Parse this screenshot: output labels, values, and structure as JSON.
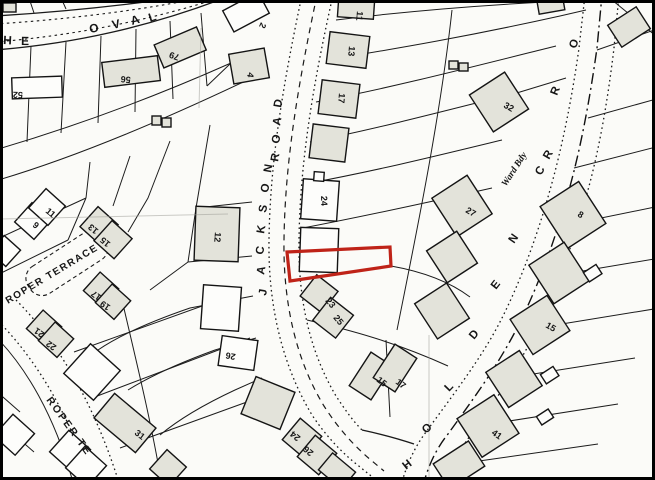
{
  "map": {
    "type": "cadastral-site-plan",
    "highlight_color": "#bf2318",
    "paper_color": "#fbfbf8",
    "streets_visible": [
      "HE OVAL",
      "JACKSON ROAD",
      "ROPER TERRACE",
      "ROPER TE",
      "HOLDEN",
      "CR",
      "RO"
    ],
    "annotation": "Ward Bdy",
    "plot_numbers_visible": [
      "52",
      "56",
      "79",
      "2",
      "4",
      "12",
      "11",
      "13",
      "17",
      "24",
      "23",
      "25",
      "26",
      "9",
      "11",
      "13",
      "15",
      "17",
      "19",
      "21",
      "22",
      "31",
      "24",
      "26",
      "15",
      "17",
      "41",
      "27",
      "32",
      "8",
      "15"
    ]
  },
  "labels": [
    {
      "name": "street-letter-oval-h",
      "text": "H",
      "x": 3,
      "y": 44,
      "rot": 3,
      "fs": 12,
      "cls": "street"
    },
    {
      "name": "street-letter-oval-e",
      "text": "E",
      "x": 21,
      "y": 45,
      "rot": 1,
      "fs": 12,
      "cls": "street"
    },
    {
      "name": "street-letter-oval-o",
      "text": "O",
      "x": 90,
      "y": 33,
      "rot": -10,
      "fs": 12,
      "cls": "street"
    },
    {
      "name": "street-letter-oval-v",
      "text": "V",
      "x": 113,
      "y": 29,
      "rot": -13,
      "fs": 12,
      "cls": "street"
    },
    {
      "name": "street-letter-oval-a",
      "text": "A",
      "x": 132,
      "y": 25,
      "rot": -16,
      "fs": 12,
      "cls": "street"
    },
    {
      "name": "street-letter-oval-l",
      "text": "L",
      "x": 150,
      "y": 22,
      "rot": -18,
      "fs": 12,
      "cls": "street"
    },
    {
      "name": "street-letter-jackson-j",
      "text": "J",
      "x": 266,
      "y": 296,
      "rot": -80,
      "fs": 11.5,
      "cls": "street"
    },
    {
      "name": "street-letter-jackson-a",
      "text": "A",
      "x": 264,
      "y": 275,
      "rot": -80,
      "fs": 11.5,
      "cls": "street"
    },
    {
      "name": "street-letter-jackson-c",
      "text": "C",
      "x": 263,
      "y": 255,
      "rot": -80,
      "fs": 11.5,
      "cls": "street"
    },
    {
      "name": "street-letter-jackson-k",
      "text": "K",
      "x": 264,
      "y": 234,
      "rot": -80,
      "fs": 11.5,
      "cls": "street"
    },
    {
      "name": "street-letter-jackson-s",
      "text": "S",
      "x": 266,
      "y": 213,
      "rot": -80,
      "fs": 11.5,
      "cls": "street"
    },
    {
      "name": "street-letter-jackson-o",
      "text": "O",
      "x": 268,
      "y": 193,
      "rot": -80,
      "fs": 11.5,
      "cls": "street"
    },
    {
      "name": "street-letter-jackson-n",
      "text": "N",
      "x": 271,
      "y": 173,
      "rot": -80,
      "fs": 11.5,
      "cls": "street"
    },
    {
      "name": "street-letter-road-r",
      "text": "R",
      "x": 278,
      "y": 162,
      "rot": -80,
      "fs": 11.5,
      "cls": "street"
    },
    {
      "name": "street-letter-road-o",
      "text": "O",
      "x": 279,
      "y": 144,
      "rot": -80,
      "fs": 11.5,
      "cls": "street"
    },
    {
      "name": "street-letter-road-a",
      "text": "A",
      "x": 280,
      "y": 126,
      "rot": -80,
      "fs": 11.5,
      "cls": "street"
    },
    {
      "name": "street-letter-road-d",
      "text": "D",
      "x": 281,
      "y": 108,
      "rot": -80,
      "fs": 11.5,
      "cls": "street"
    },
    {
      "name": "street-letter-holden-h",
      "text": "H",
      "x": 406,
      "y": 470,
      "rot": -38,
      "fs": 11.5,
      "cls": "street"
    },
    {
      "name": "street-letter-holden-o",
      "text": "O",
      "x": 426,
      "y": 434,
      "rot": -42,
      "fs": 11.5,
      "cls": "street"
    },
    {
      "name": "street-letter-holden-l",
      "text": "L",
      "x": 449,
      "y": 392,
      "rot": -46,
      "fs": 11.5,
      "cls": "street"
    },
    {
      "name": "street-letter-holden-d",
      "text": "D",
      "x": 474,
      "y": 340,
      "rot": -50,
      "fs": 11.5,
      "cls": "street"
    },
    {
      "name": "street-letter-holden-e",
      "text": "E",
      "x": 496,
      "y": 290,
      "rot": -52,
      "fs": 11.5,
      "cls": "street"
    },
    {
      "name": "street-letter-holden-n",
      "text": "N",
      "x": 514,
      "y": 244,
      "rot": -55,
      "fs": 11.5,
      "cls": "street"
    },
    {
      "name": "street-letter-cr-c",
      "text": "C",
      "x": 541,
      "y": 176,
      "rot": -60,
      "fs": 11.5,
      "cls": "street"
    },
    {
      "name": "street-letter-cr-r",
      "text": "R",
      "x": 549,
      "y": 160,
      "rot": -60,
      "fs": 11.5,
      "cls": "street"
    },
    {
      "name": "street-letter-ro-r",
      "text": "R",
      "x": 557,
      "y": 96,
      "rot": -68,
      "fs": 11.5,
      "cls": "street"
    },
    {
      "name": "street-letter-ro-o",
      "text": "O",
      "x": 576,
      "y": 49,
      "rot": -72,
      "fs": 11.5,
      "cls": "street"
    },
    {
      "name": "ward-bdy-label",
      "text": "Ward Bdy",
      "x": 506,
      "y": 187,
      "rot": -57,
      "fs": 9.5,
      "cls": "ward"
    },
    {
      "name": "street-label-roper-terrace",
      "text": "ROPER TERRACE",
      "x": 8,
      "y": 304,
      "rot": -31,
      "fs": 10,
      "ls": 1.5,
      "cls": "streetw"
    },
    {
      "name": "street-label-roper-te",
      "text": "ROPER TE",
      "x": 46,
      "y": 400,
      "rot": 54,
      "fs": 10.5,
      "ls": 2,
      "cls": "streetw"
    },
    {
      "name": "plot-number",
      "text": "52",
      "x": 23,
      "y": 92,
      "rot": 182,
      "fs": 9,
      "cls": "num"
    },
    {
      "name": "plot-number",
      "text": "56",
      "x": 131,
      "y": 77,
      "rot": 186,
      "fs": 9,
      "cls": "num"
    },
    {
      "name": "plot-number",
      "text": "79",
      "x": 180,
      "y": 55,
      "rot": 200,
      "fs": 9,
      "cls": "num"
    },
    {
      "name": "plot-number",
      "text": "2",
      "x": 261,
      "y": 22,
      "rot": 115,
      "fs": 9,
      "cls": "num"
    },
    {
      "name": "plot-number",
      "text": "4",
      "x": 248,
      "y": 72,
      "rot": 100,
      "fs": 9,
      "cls": "num"
    },
    {
      "name": "plot-number",
      "text": "12",
      "x": 215,
      "y": 232,
      "rot": 95,
      "fs": 9,
      "cls": "num"
    },
    {
      "name": "plot-number",
      "text": "11",
      "x": 357,
      "y": 11,
      "rot": 95,
      "fs": 9,
      "cls": "num"
    },
    {
      "name": "plot-number",
      "text": "13",
      "x": 349,
      "y": 46,
      "rot": 95,
      "fs": 9,
      "cls": "num"
    },
    {
      "name": "plot-number",
      "text": "17",
      "x": 339,
      "y": 93,
      "rot": 95,
      "fs": 9,
      "cls": "num"
    },
    {
      "name": "plot-number",
      "text": "24",
      "x": 321,
      "y": 196,
      "rot": 88,
      "fs": 9,
      "cls": "num"
    },
    {
      "name": "plot-number",
      "text": "23",
      "x": 325,
      "y": 301,
      "rot": 50,
      "fs": 9,
      "cls": "num"
    },
    {
      "name": "plot-number",
      "text": "25",
      "x": 333,
      "y": 318,
      "rot": 50,
      "fs": 9,
      "cls": "num"
    },
    {
      "name": "plot-number",
      "text": "26",
      "x": 236,
      "y": 354,
      "rot": 190,
      "fs": 9,
      "cls": "num"
    },
    {
      "name": "plot-number",
      "text": "24",
      "x": 301,
      "y": 437,
      "rot": 220,
      "fs": 9,
      "cls": "num"
    },
    {
      "name": "plot-number",
      "text": "26",
      "x": 314,
      "y": 452,
      "rot": 220,
      "fs": 9,
      "cls": "num"
    },
    {
      "name": "plot-number",
      "text": "9",
      "x": 32,
      "y": 226,
      "rot": 40,
      "fs": 9,
      "cls": "num"
    },
    {
      "name": "plot-number",
      "text": "11",
      "x": 45,
      "y": 212,
      "rot": 40,
      "fs": 9,
      "cls": "num"
    },
    {
      "name": "plot-number",
      "text": "13",
      "x": 99,
      "y": 230,
      "rot": 220,
      "fs": 9,
      "cls": "num"
    },
    {
      "name": "plot-number",
      "text": "15",
      "x": 111,
      "y": 243,
      "rot": 220,
      "fs": 9,
      "cls": "num"
    },
    {
      "name": "plot-number",
      "text": "17",
      "x": 102,
      "y": 296,
      "rot": 215,
      "fs": 9,
      "cls": "num"
    },
    {
      "name": "plot-number",
      "text": "19",
      "x": 111,
      "y": 306,
      "rot": 215,
      "fs": 9,
      "cls": "num"
    },
    {
      "name": "plot-number",
      "text": "21",
      "x": 45,
      "y": 333,
      "rot": 215,
      "fs": 9,
      "cls": "num"
    },
    {
      "name": "plot-number",
      "text": "22",
      "x": 57,
      "y": 346,
      "rot": 215,
      "fs": 9,
      "cls": "num"
    },
    {
      "name": "plot-number",
      "text": "31",
      "x": 134,
      "y": 434,
      "rot": 38,
      "fs": 9,
      "cls": "num"
    },
    {
      "name": "plot-number",
      "text": "15",
      "x": 376,
      "y": 381,
      "rot": 38,
      "fs": 9,
      "cls": "num"
    },
    {
      "name": "plot-number",
      "text": "17",
      "x": 395,
      "y": 383,
      "rot": 38,
      "fs": 9,
      "cls": "num"
    },
    {
      "name": "plot-number",
      "text": "41",
      "x": 491,
      "y": 434,
      "rot": 35,
      "fs": 9,
      "cls": "num"
    },
    {
      "name": "plot-number",
      "text": "27",
      "x": 465,
      "y": 212,
      "rot": 30,
      "fs": 9,
      "cls": "num"
    },
    {
      "name": "plot-number",
      "text": "32",
      "x": 503,
      "y": 107,
      "rot": 30,
      "fs": 9,
      "cls": "num"
    },
    {
      "name": "plot-number",
      "text": "8",
      "x": 577,
      "y": 216,
      "rot": 30,
      "fs": 9,
      "cls": "num"
    },
    {
      "name": "plot-number",
      "text": "15",
      "x": 545,
      "y": 327,
      "rot": 30,
      "fs": 9,
      "cls": "num"
    }
  ]
}
